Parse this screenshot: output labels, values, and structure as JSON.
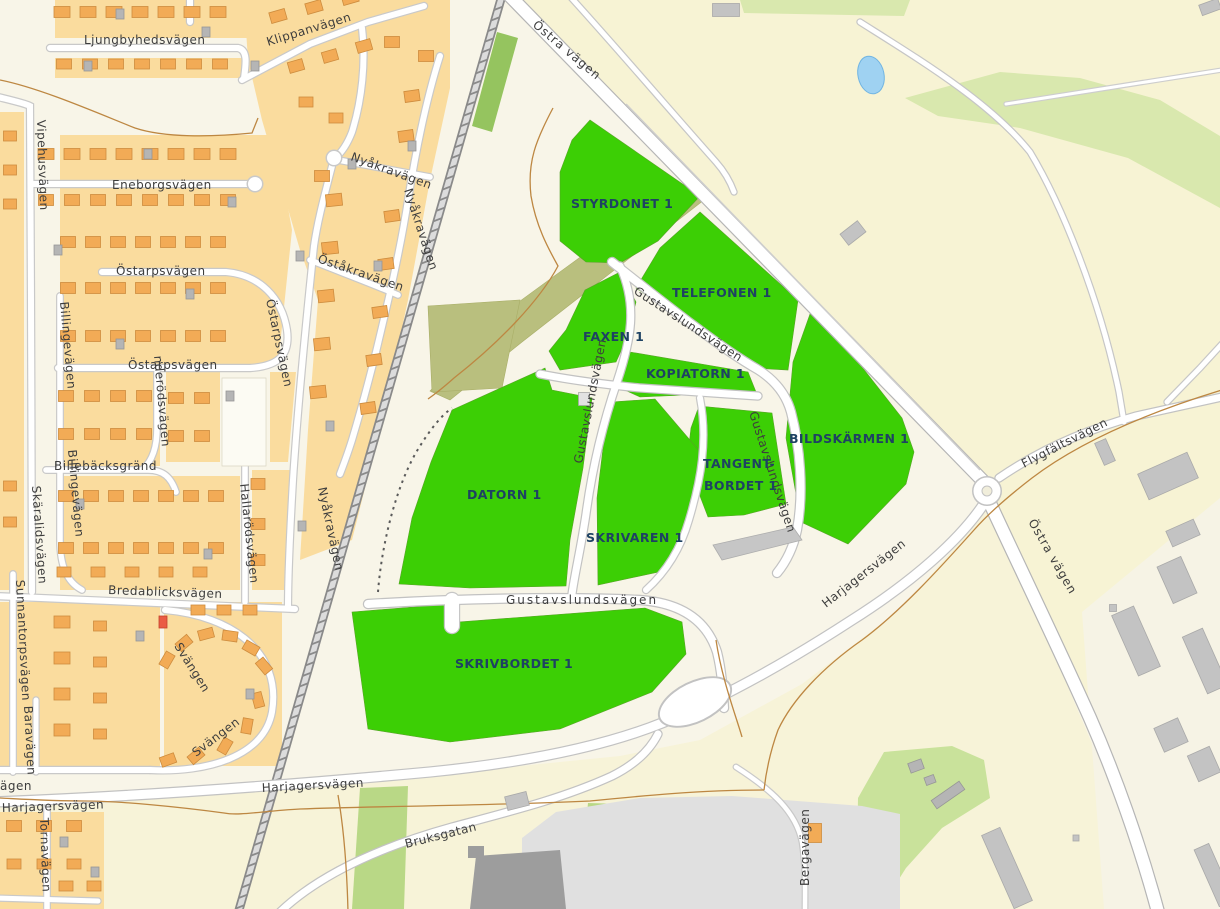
{
  "map_kind": "municipal-plot-map",
  "colors": {
    "plot_green": "#3ccf05",
    "plot_label": "#1e4263",
    "street_label": "#3d3d3d",
    "residential_block": "#fadc9e",
    "building_orange": "#f2ab56",
    "water_blue": "#9fd2f2",
    "greenbelt_khaki": "#b9bf7e"
  },
  "plots": [
    {
      "id": "styrdonet",
      "label": "STYRDONET 1"
    },
    {
      "id": "telefonen",
      "label": "TELEFONEN 1"
    },
    {
      "id": "faxen",
      "label": "FAXEN 1"
    },
    {
      "id": "kopiatorn",
      "label": "KOPIATORN 1"
    },
    {
      "id": "bildskarmen",
      "label": "BILDSKÄRMEN 1"
    },
    {
      "id": "tangentbordet",
      "label_line1": "TANGENT-",
      "label_line2": "BORDET 1"
    },
    {
      "id": "datorn",
      "label": "DATORN 1"
    },
    {
      "id": "skrivaren",
      "label": "SKRIVAREN 1"
    },
    {
      "id": "skrivbordet",
      "label": "SKRIVBORDET 1"
    }
  ],
  "street_labels": [
    {
      "text": "Ljungbyhedsvägen"
    },
    {
      "text": "Klippanvägen"
    },
    {
      "text": "Vipehusvägen"
    },
    {
      "text": "Eneborgsvägen"
    },
    {
      "text": "Östarpsvägen"
    },
    {
      "text": "Östarpsvägen"
    },
    {
      "text": "Östarpsvägen"
    },
    {
      "text": "Nyåkravägen"
    },
    {
      "text": "Nyåkravägen"
    },
    {
      "text": "Nyåkravägen"
    },
    {
      "text": "Öståkravägen"
    },
    {
      "text": "Billingevägen"
    },
    {
      "text": "Billingevägen"
    },
    {
      "text": "nderödsvägen"
    },
    {
      "text": "Billebäcksgränd"
    },
    {
      "text": "Skäralidsvägen"
    },
    {
      "text": "Hallarödsvägen"
    },
    {
      "text": "Bredablicksvägen"
    },
    {
      "text": "Sunnantorpsvägen"
    },
    {
      "text": "Baravägen"
    },
    {
      "text": "Svängen"
    },
    {
      "text": "Svängen"
    },
    {
      "text": "Tornavägen"
    },
    {
      "text": "Harjagersvägen"
    },
    {
      "text": "ägen"
    },
    {
      "text": "Harjagersvägen"
    },
    {
      "text": "Harjagersvägen"
    },
    {
      "text": "Bruksgatan"
    },
    {
      "text": "Bergavägen"
    },
    {
      "text": "Östra vägen"
    },
    {
      "text": "Östra vägen"
    },
    {
      "text": "Flygfältsvägen"
    },
    {
      "text": "Gustavslundsvägen"
    },
    {
      "text": "Gustavslundsvägen"
    },
    {
      "text": "Gustavslundsvägen"
    },
    {
      "text": "Gustavslundsvägen"
    }
  ]
}
